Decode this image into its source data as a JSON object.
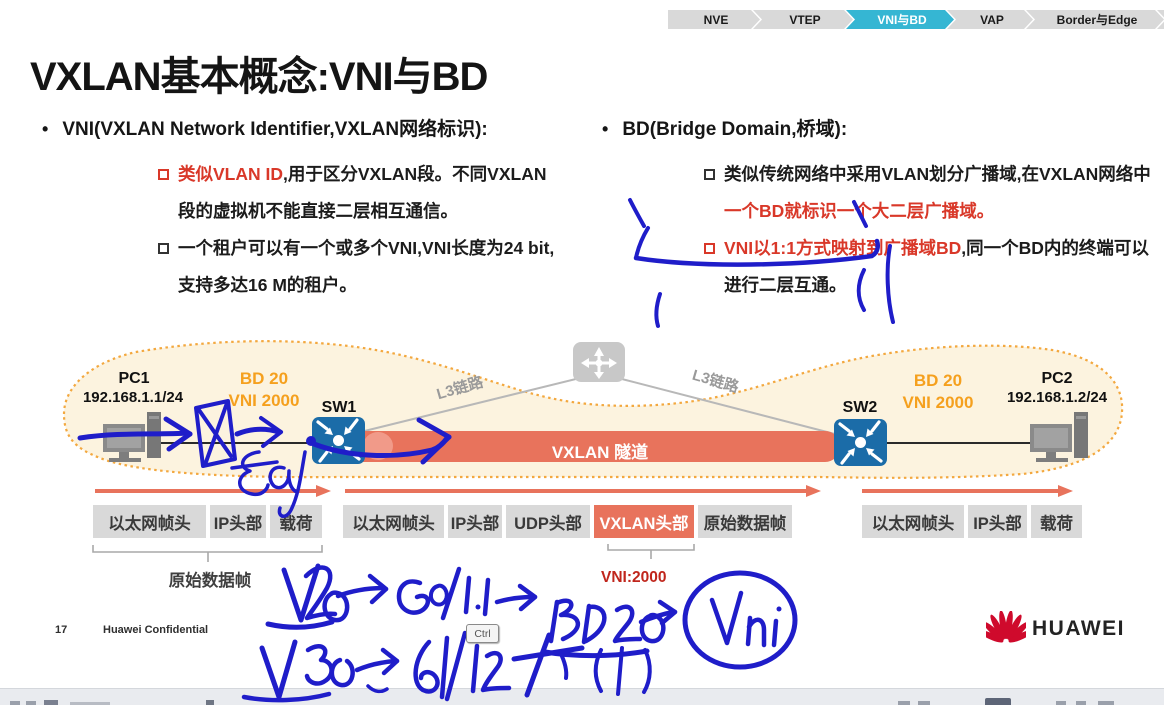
{
  "breadcrumb": {
    "items": [
      {
        "label": "NVE",
        "active": false
      },
      {
        "label": "VTEP",
        "active": false
      },
      {
        "label": "VNI与BD",
        "active": true
      },
      {
        "label": "VAP",
        "active": false
      },
      {
        "label": "Border与Edge",
        "active": false
      },
      {
        "label": "网关",
        "active": false
      }
    ]
  },
  "title": "VXLAN基本概念:VNI与BD",
  "sections": {
    "vni": {
      "heading": "VNI(VXLAN Network Identifier,VXLAN网络标识):",
      "b1_red": "类似VLAN ID",
      "b1_rest": ",用于区分VXLAN段。不同VXLAN段的虚拟机不能直接二层相互通信。",
      "b2": "一个租户可以有一个或多个VNI,VNI长度为24 bit,支持多达16 M的租户。"
    },
    "bd": {
      "heading": "BD(Bridge Domain,桥域):",
      "b1_black": "类似传统网络中采用VLAN划分广播域,在VXLAN网络中",
      "b1_red": "一个BD就标识一个大二层广播域。",
      "b2_red": "VNI以1:1方式映射到广播域BD",
      "b2_rest": ",同一个BD内的终端可以进行二层互通。"
    }
  },
  "diagram": {
    "pc1": {
      "name": "PC1",
      "ip": "192.168.1.1/24"
    },
    "pc2": {
      "name": "PC2",
      "ip": "192.168.1.2/24"
    },
    "sw1": "SW1",
    "sw2": "SW2",
    "bd_left": {
      "bd": "BD 20",
      "vni": "VNI 2000"
    },
    "bd_right": {
      "bd": "BD 20",
      "vni": "VNI 2000"
    },
    "l3_left": "L3链路",
    "l3_right": "L3链路",
    "tunnel_label": "VXLAN 隧道"
  },
  "frames": {
    "left": {
      "cells": [
        "以太网帧头",
        "IP头部",
        "载荷"
      ],
      "caption": "原始数据帧"
    },
    "middle": {
      "cells": [
        "以太网帧头",
        "IP头部",
        "UDP头部",
        "VXLAN头部",
        "原始数据帧"
      ],
      "vni_caption": "VNI:2000"
    },
    "right": {
      "cells": [
        "以太网帧头",
        "IP头部",
        "载荷"
      ]
    }
  },
  "handwriting_notes": {
    "line1": "V20 → G0/1.1 → BD20 → VNi",
    "line2": "V30 → G0/1.2"
  },
  "overlay": {
    "ctrl_key": "Ctrl"
  },
  "footer": {
    "page": "17",
    "text": "Huawei Confidential"
  },
  "logo": {
    "text": "HUAWEI"
  },
  "colors": {
    "accent_red": "#D93829",
    "orange": "#F5A01E",
    "tunnel_salmon": "#E8735C",
    "switch_blue": "#1B6CA8",
    "pen_blue": "#1F1DC9",
    "breadcrumb_active": "#35B6D3",
    "huawei_red": "#CF0A2C"
  }
}
